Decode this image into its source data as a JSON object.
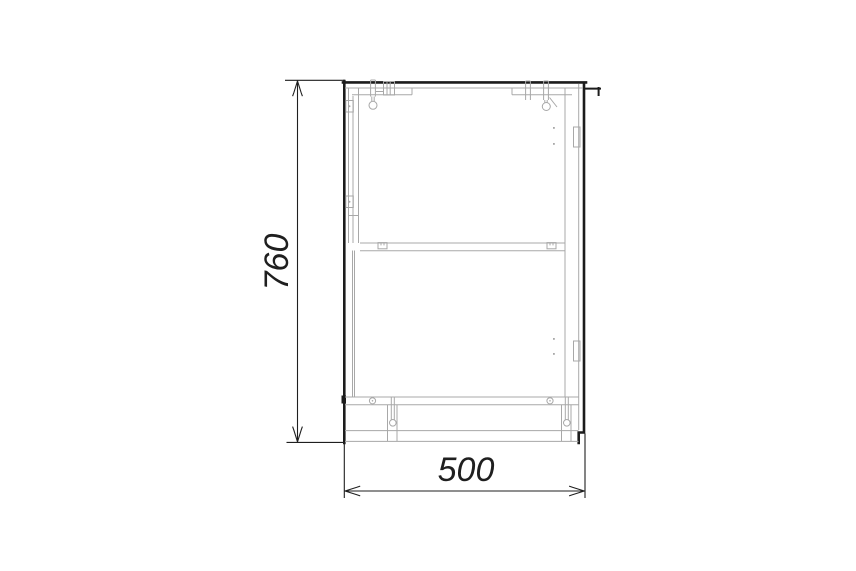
{
  "drawing": {
    "title": "cabinet-front-elevation-technical-drawing",
    "dimensions": {
      "height": {
        "value": "760",
        "orientation": "vertical"
      },
      "width": {
        "value": "500",
        "orientation": "horizontal"
      }
    },
    "colors": {
      "background": "#ffffff",
      "outline": "#1c1c1c",
      "detail_lines": "#a8a8a8",
      "dimension_lines": "#1f1f1f",
      "text": "#1f1f1f"
    }
  }
}
